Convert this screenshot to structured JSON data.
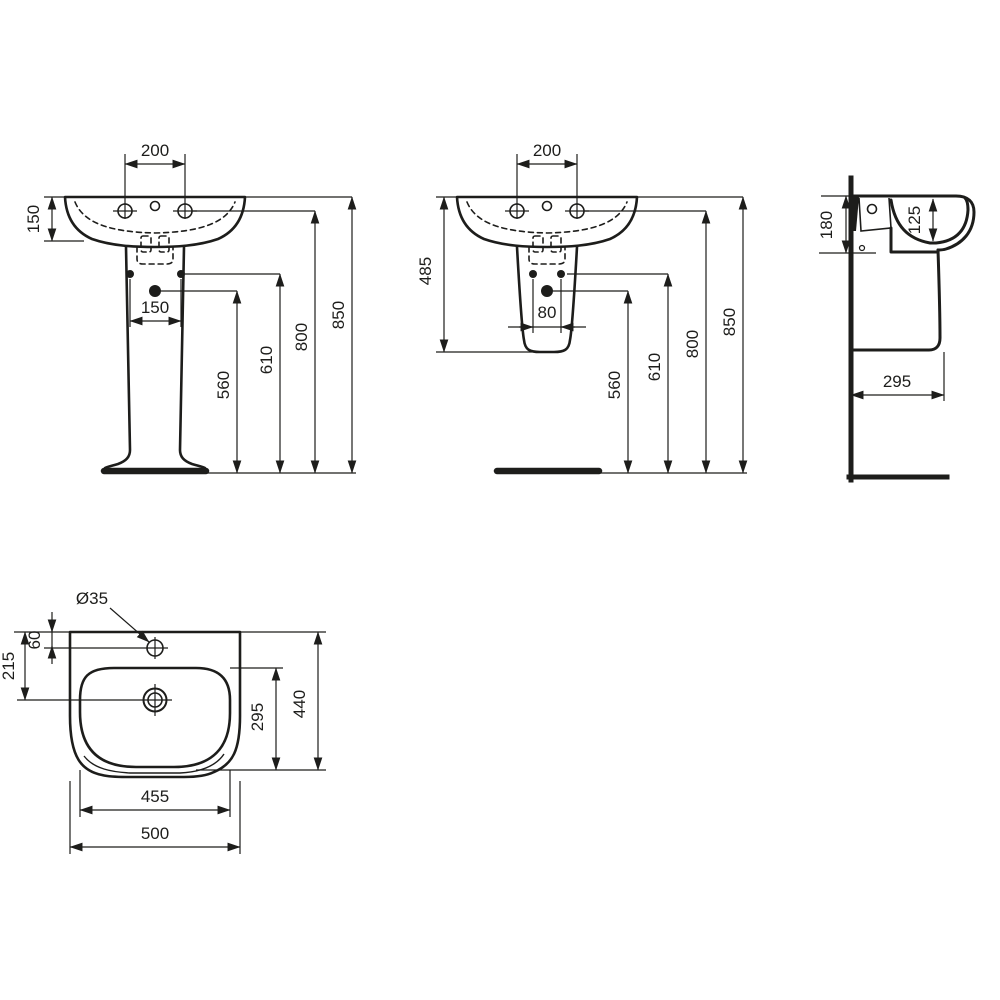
{
  "drawing_title": "Washbasin technical dimension drawing",
  "colors": {
    "line": "#1d1d1b",
    "background": "#ffffff"
  },
  "views": {
    "front_pedestal": {
      "name": "front view with full pedestal",
      "dim_tap_hole_spacing": "200",
      "dim_basin_height": "150",
      "dim_fixing_hole_spacing": "150",
      "dim_height_drain": "560",
      "dim_height_fixing": "610",
      "dim_height_taphole": "800",
      "dim_height_rim": "850"
    },
    "front_semi_pedestal": {
      "name": "front view with semi-pedestal",
      "dim_tap_hole_spacing": "200",
      "dim_basin_semi_height": "485",
      "dim_fixing_hole_spacing": "80",
      "dim_height_drain": "560",
      "dim_height_fixing": "610",
      "dim_height_taphole": "800",
      "dim_height_rim": "850"
    },
    "side": {
      "name": "side section view",
      "dim_front_height": "180",
      "dim_bowl_depth": "125",
      "dim_projection": "295"
    },
    "plan": {
      "name": "plan (top) view",
      "dim_tap_hole_diameter": "Ø35",
      "dim_tap_hole_offset": "60",
      "dim_drain_offset": "215",
      "dim_bowl_length": "295",
      "dim_overall_depth": "440",
      "dim_bowl_width": "455",
      "dim_overall_width": "500"
    }
  }
}
